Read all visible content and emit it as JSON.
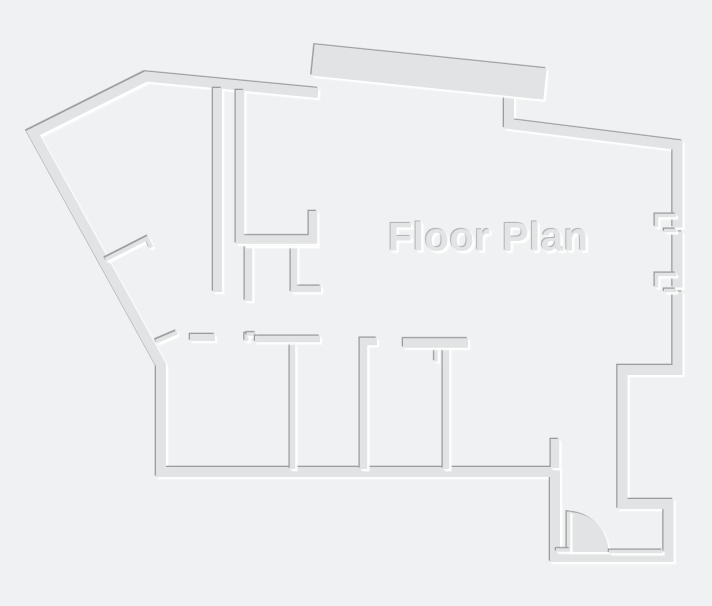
{
  "title": {
    "label": "Floor Plan"
  },
  "colors": {
    "background": "#f0f1f2",
    "wall": "#e1e3e4",
    "shadow_dark": "#9a9c9e",
    "highlight": "#ffffff",
    "title_fill": "#e3e4e5",
    "title_shadow": "#b4b6b8"
  }
}
